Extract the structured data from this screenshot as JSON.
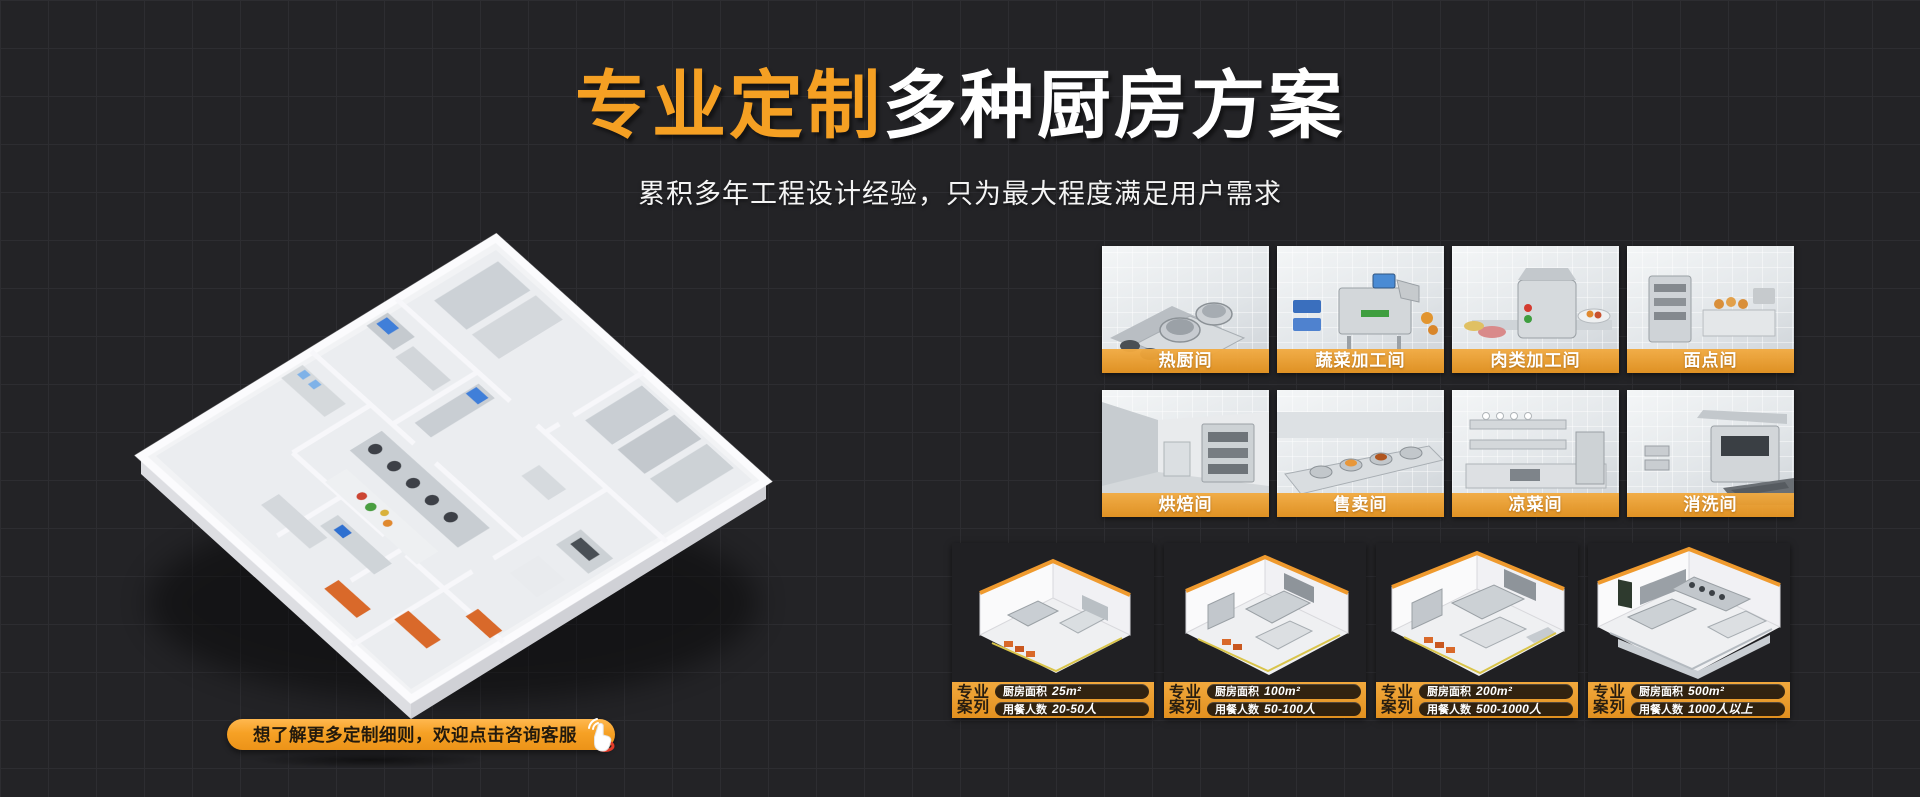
{
  "theme": {
    "background": "#232326",
    "grid_line": "#2d2d31",
    "accent_orange": "#f5a023",
    "banner_top": "#f2a93d",
    "banner_bottom": "#e2901f",
    "text_light": "#ffffff",
    "text_dark": "#271d10"
  },
  "header": {
    "title_highlight": "专业定制",
    "title_rest": "多种厨房方案",
    "subtitle": "累积多年工程设计经验，只为最大程度满足用户需求"
  },
  "cta": {
    "label": "想了解更多定制细则，欢迎点击咨询客服",
    "icon": "click-hand-icon"
  },
  "rooms": [
    {
      "label": "热厨间"
    },
    {
      "label": "蔬菜加工间"
    },
    {
      "label": "肉类加工间"
    },
    {
      "label": "面点间"
    },
    {
      "label": "烘焙间"
    },
    {
      "label": "售卖间"
    },
    {
      "label": "凉菜间"
    },
    {
      "label": "消洗间"
    }
  ],
  "cases": [
    {
      "tag_line1": "专业",
      "tag_line2": "案列",
      "area_label": "厨房面积",
      "area_value": "25m²",
      "diners_label": "用餐人数",
      "diners_value": "20-50人"
    },
    {
      "tag_line1": "专业",
      "tag_line2": "案列",
      "area_label": "厨房面积",
      "area_value": "100m²",
      "diners_label": "用餐人数",
      "diners_value": "50-100人"
    },
    {
      "tag_line1": "专业",
      "tag_line2": "案列",
      "area_label": "厨房面积",
      "area_value": "200m²",
      "diners_label": "用餐人数",
      "diners_value": "500-1000人"
    },
    {
      "tag_line1": "专业",
      "tag_line2": "案列",
      "area_label": "厨房面积",
      "area_value": "500m²",
      "diners_label": "用餐人数",
      "diners_value": "1000人以上"
    }
  ]
}
